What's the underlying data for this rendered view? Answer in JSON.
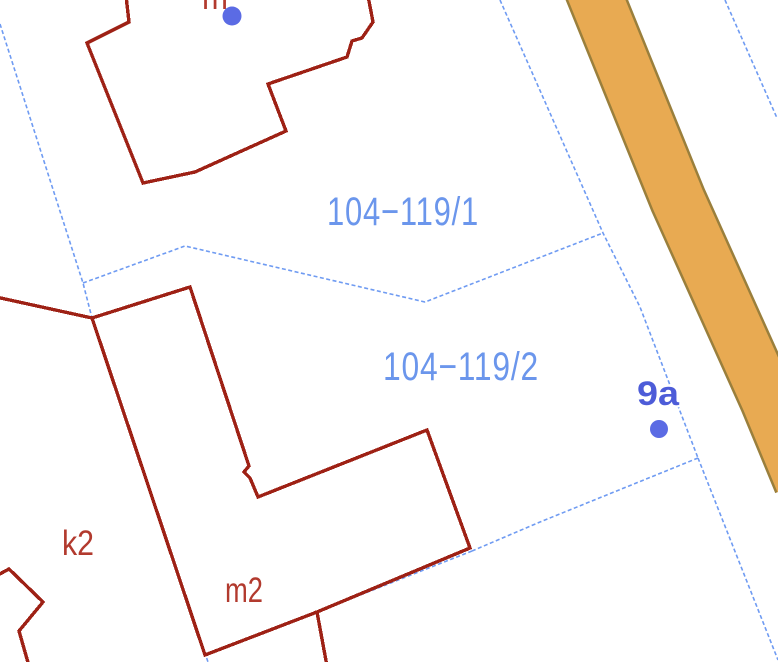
{
  "map": {
    "type": "cadastral-parcel-map",
    "parcel_labels": [
      {
        "text": "104−119/1"
      },
      {
        "text": "104−119/2"
      }
    ],
    "house_number": {
      "text": "9a"
    },
    "building_labels": [
      {
        "text": "k2"
      },
      {
        "text": "m2"
      },
      {
        "text": "m"
      }
    ],
    "address_points": 2
  },
  "colors": {
    "background": "#ffffff",
    "road_fill": "#E8AA52",
    "road_border": "#9A7F3C",
    "boundary_blue": "#6F9BF2",
    "building_red": "#9E2115",
    "label_blue": "#6B96EC",
    "label_red": "#B23A2E",
    "house_number_blue": "#4D5CD8",
    "dot_blue": "#5B6BE4"
  }
}
